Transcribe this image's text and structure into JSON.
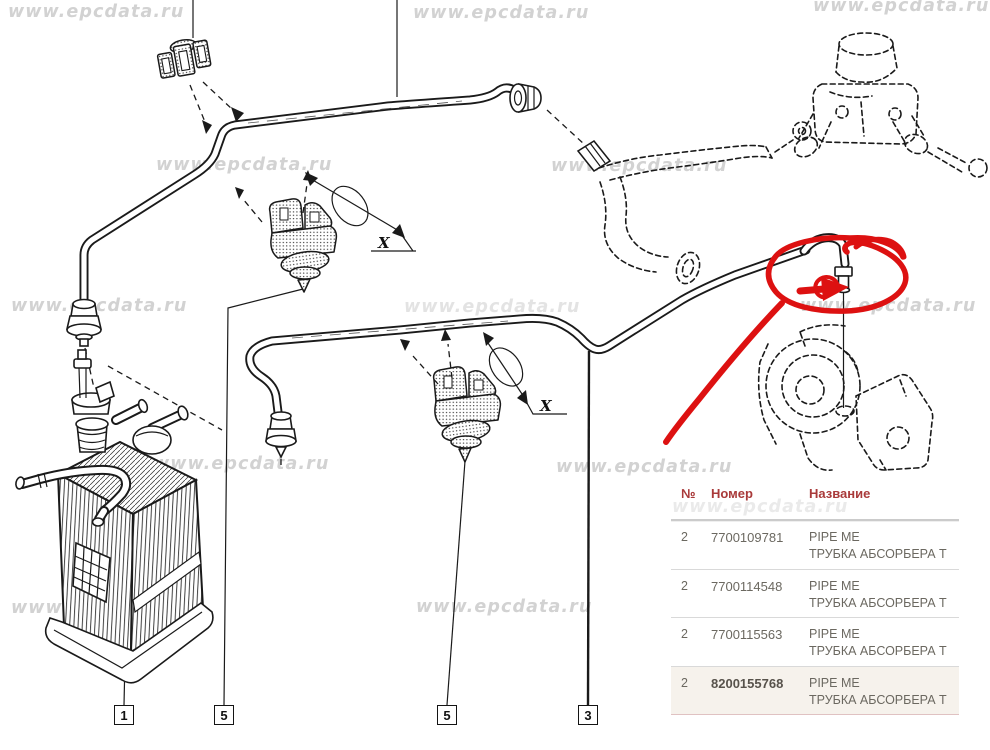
{
  "watermark": {
    "text": "www.epcdata.ru",
    "positions": [
      {
        "x": 8,
        "y": 2
      },
      {
        "x": 413,
        "y": 3
      },
      {
        "x": 813,
        "y": -4
      },
      {
        "x": 156,
        "y": 155
      },
      {
        "x": 551,
        "y": 156
      },
      {
        "x": 11,
        "y": 296
      },
      {
        "x": 404,
        "y": 297,
        "o": 0.6
      },
      {
        "x": 800,
        "y": 296
      },
      {
        "x": 153,
        "y": 454
      },
      {
        "x": 556,
        "y": 457
      },
      {
        "x": 672,
        "y": 497,
        "o": 0.45
      },
      {
        "x": 11,
        "y": 598
      },
      {
        "x": 416,
        "y": 597
      }
    ]
  },
  "diagram": {
    "dimension_label": "X",
    "callouts": [
      "1",
      "5",
      "5",
      "3"
    ]
  },
  "table": {
    "columns": [
      "№",
      "Номер",
      "Название"
    ],
    "rows": [
      {
        "num": "2",
        "part": "7700109781",
        "name_en": "PIPE ME",
        "name_ru": "ТРУБКА АБСОРБЕРА Т",
        "highlight": false
      },
      {
        "num": "2",
        "part": "7700114548",
        "name_en": "PIPE ME",
        "name_ru": "ТРУБКА АБСОРБЕРА Т",
        "highlight": false
      },
      {
        "num": "2",
        "part": "7700115563",
        "name_en": "PIPE ME",
        "name_ru": "ТРУБКА АБСОРБЕРА Т",
        "highlight": false
      },
      {
        "num": "2",
        "part": "8200155768",
        "name_en": "PIPE ME",
        "name_ru": "ТРУБКА АБСОРБЕРА Т",
        "highlight": true
      }
    ]
  },
  "colors": {
    "annotation": "#dd1111",
    "table_header": "#a93a3a",
    "table_text": "#6b6860",
    "highlight_bg": "#f6f2ec"
  }
}
